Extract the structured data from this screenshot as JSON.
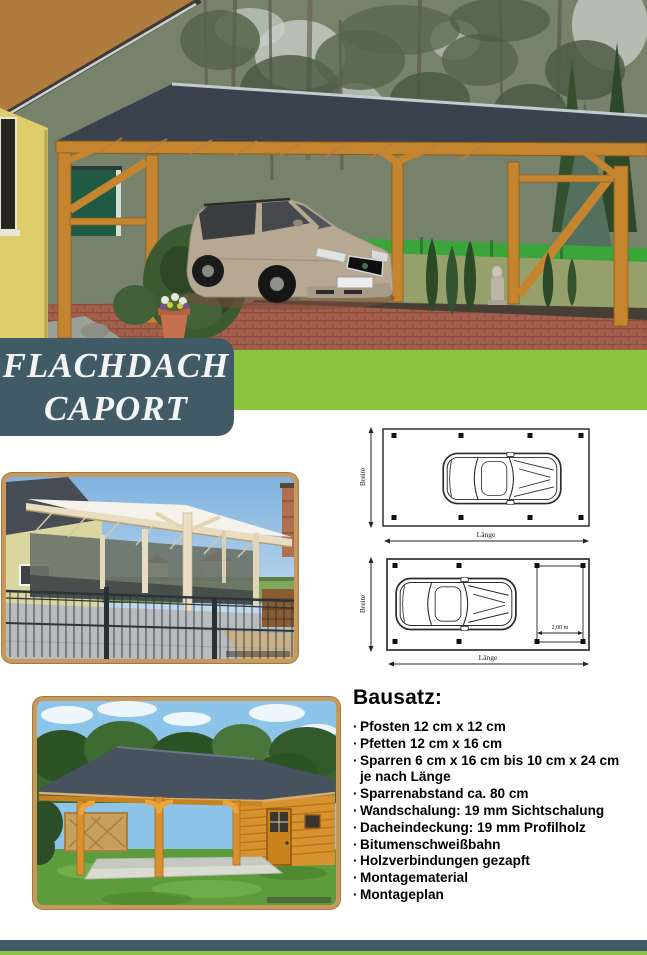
{
  "banner": {
    "line1": "FLACHDACH",
    "line2": "CAPORT"
  },
  "colors": {
    "accent_green": "#8cc63e",
    "slate": "#405a66",
    "frame_wood": "#c9995c"
  },
  "diagrams": {
    "plan1": {
      "breite": "Breite",
      "laenge": "Länge"
    },
    "plan2": {
      "breite": "Breite",
      "laenge": "Länge",
      "storage": "2,00 m"
    }
  },
  "bausatz": {
    "heading": "Bausatz:",
    "bullet_char": "·",
    "items": [
      {
        "text": "Pfosten 12 cm x 12 cm"
      },
      {
        "text": "Pfetten 12 cm x 16 cm"
      },
      {
        "text": "Sparren 6 cm x 16 cm bis 10 cm x 24 cm"
      },
      {
        "text": "je nach Länge",
        "continuation": true
      },
      {
        "text": "Sparrenabstand ca. 80 cm"
      },
      {
        "text": "Wandschalung: 19 mm Sichtschalung"
      },
      {
        "text": "Dacheindeckung: 19 mm Profilholz"
      },
      {
        "text": "Bitumenschweißbahn"
      },
      {
        "text": "Holzverbindungen gezapft"
      },
      {
        "text": "Montagematerial"
      },
      {
        "text": "Montageplan"
      }
    ]
  }
}
